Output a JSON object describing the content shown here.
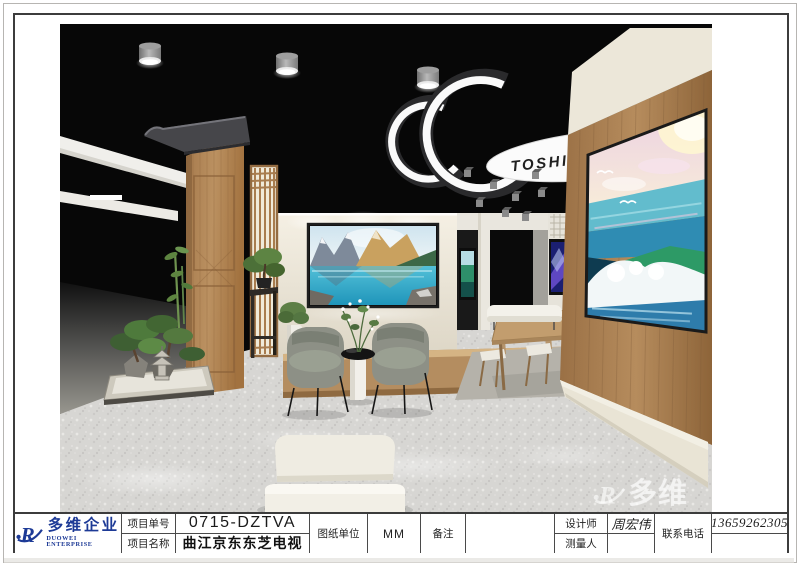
{
  "logo": {
    "company_cn": "多维企业",
    "company_en": "DUOWEI ENTERPRISE"
  },
  "title_block": {
    "project_no_label": "项目单号",
    "project_no_value": "0715-DZTVA",
    "project_name_label": "项目名称",
    "project_name_value": "曲江京东东芝电视",
    "unit_label": "图纸单位",
    "unit_value": "MM",
    "remark_label": "备注",
    "remark_value": "",
    "designer_label": "设计师",
    "designer_value": "周宏伟",
    "surveyor_label": "测量人",
    "surveyor_value": "",
    "phone_label": "联系电话",
    "phone_value": "13659262305"
  },
  "render": {
    "toshiba_sign": "TOSHIBA",
    "watermark_text": "多维"
  },
  "colors": {
    "logo_blue": "#1d3a96",
    "frame": "#3c3c3c",
    "ceiling_black": "#070707",
    "wood": "#ad8257",
    "cream_wall": "#ece6d9"
  }
}
